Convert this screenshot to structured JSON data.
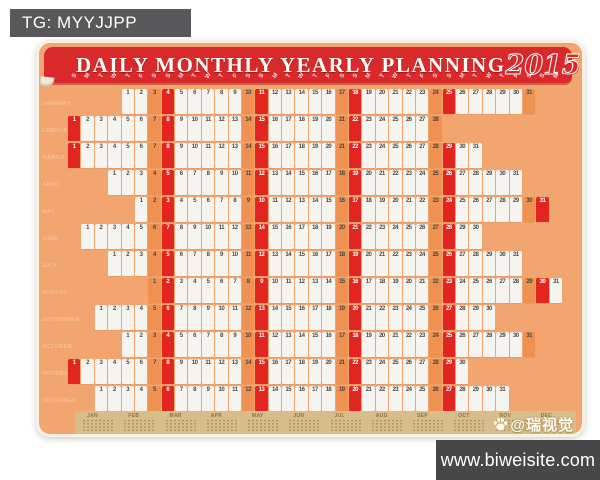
{
  "overlay": {
    "tg_label": "TG: MYYJJPP",
    "site_url": "www.biweisite.com",
    "watermark_credit": "@瑞视觉"
  },
  "poster": {
    "title": "DAILY MONTHLY YEARLY PLANNING",
    "year": "2015",
    "first_column_weekday": "Sunday",
    "columns": 37,
    "weekday_letters": [
      "S",
      "M",
      "T",
      "W",
      "T",
      "F",
      "S"
    ],
    "months": [
      {
        "name": "JANUARY",
        "start_col": 5,
        "days_shown": 31
      },
      {
        "name": "FEBRUARY",
        "start_col": 1,
        "days_shown": 28
      },
      {
        "name": "MARCH",
        "start_col": 1,
        "days_shown": 31
      },
      {
        "name": "APRIL",
        "start_col": 4,
        "days_shown": 31
      },
      {
        "name": "MAY",
        "start_col": 6,
        "days_shown": 31
      },
      {
        "name": "JUNE",
        "start_col": 2,
        "days_shown": 30
      },
      {
        "name": "JULY",
        "start_col": 4,
        "days_shown": 31
      },
      {
        "name": "AUGUST",
        "start_col": 7,
        "days_shown": 31
      },
      {
        "name": "SEPTEMBER",
        "start_col": 3,
        "days_shown": 30
      },
      {
        "name": "OCTOBER",
        "start_col": 5,
        "days_shown": 31
      },
      {
        "name": "NOVEMBER",
        "start_col": 1,
        "days_shown": 30
      },
      {
        "name": "DECEMBER",
        "start_col": 3,
        "days_shown": 31
      }
    ],
    "mini_calendar_labels": [
      "JAN",
      "FEB",
      "MAR",
      "APR",
      "MAY",
      "JUN",
      "JUL",
      "AUG",
      "SEP",
      "OCT",
      "NOV",
      "DEC"
    ],
    "colors": {
      "background_orange": "#F2A56F",
      "saturday_orange": "#EF9150",
      "sunday_red": "#E2251E",
      "banner_red": "#D9292A",
      "cell_white": "#F6F4F0",
      "strip_tan": "#D7BD8B",
      "month_label_orange": "#F6C093",
      "tg_box_gray": "#58585A",
      "site_bar_gray": "#474747"
    }
  }
}
